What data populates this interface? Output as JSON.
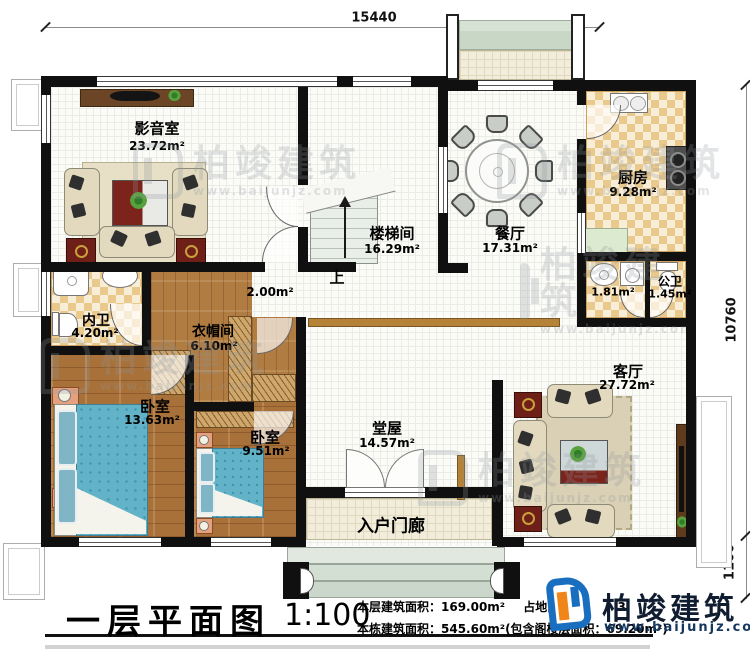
{
  "dimensions": {
    "top": "15440",
    "right_main": "10760",
    "right_porch": "1100"
  },
  "rooms": [
    {
      "id": "media",
      "name": "影音室",
      "area": "23.72m²"
    },
    {
      "id": "stair",
      "name": "楼梯间",
      "area": "16.29m²",
      "up": "上"
    },
    {
      "id": "dining",
      "name": "餐厅",
      "area": "17.31m²"
    },
    {
      "id": "kitchen",
      "name": "厨房",
      "area": "9.28m²"
    },
    {
      "id": "wash",
      "name": "",
      "area": "1.81m²"
    },
    {
      "id": "pubbath",
      "name": "公卫",
      "area": "1.45m²"
    },
    {
      "id": "innerbath",
      "name": "内卫",
      "area": "4.20m²"
    },
    {
      "id": "cloak",
      "name": "衣帽间",
      "area": "6.10m²"
    },
    {
      "id": "hallway",
      "name": "",
      "area": "2.00m²"
    },
    {
      "id": "bedroom1",
      "name": "卧室",
      "area": "13.63m²"
    },
    {
      "id": "bedroom2",
      "name": "卧室",
      "area": "9.51m²"
    },
    {
      "id": "hall",
      "name": "堂屋",
      "area": "14.57m²"
    },
    {
      "id": "living",
      "name": "客厅",
      "area": "27.72m²"
    },
    {
      "id": "porch",
      "name": "入户门廊"
    }
  ],
  "title_block": {
    "plan_name": "一层平面图",
    "scale": "1:100",
    "line1a": "本层建筑面积：169.00m²",
    "line1b_label": "占地面积：",
    "line1b_fragment": "3.",
    "line2": "本栋建筑面积：545.60m²(包含阁楼层面积：69.20m²)"
  },
  "brand": {
    "name": "柏竣建筑",
    "url": "www.baijunjz.com"
  },
  "watermark": {
    "name": "柏竣建筑",
    "url": "www.baijunjz.com"
  },
  "accent_colors": {
    "wall": "#101010",
    "wood": "#a9713a",
    "brand_blue": "#1a6ebf",
    "brand_orange": "#f08519"
  }
}
